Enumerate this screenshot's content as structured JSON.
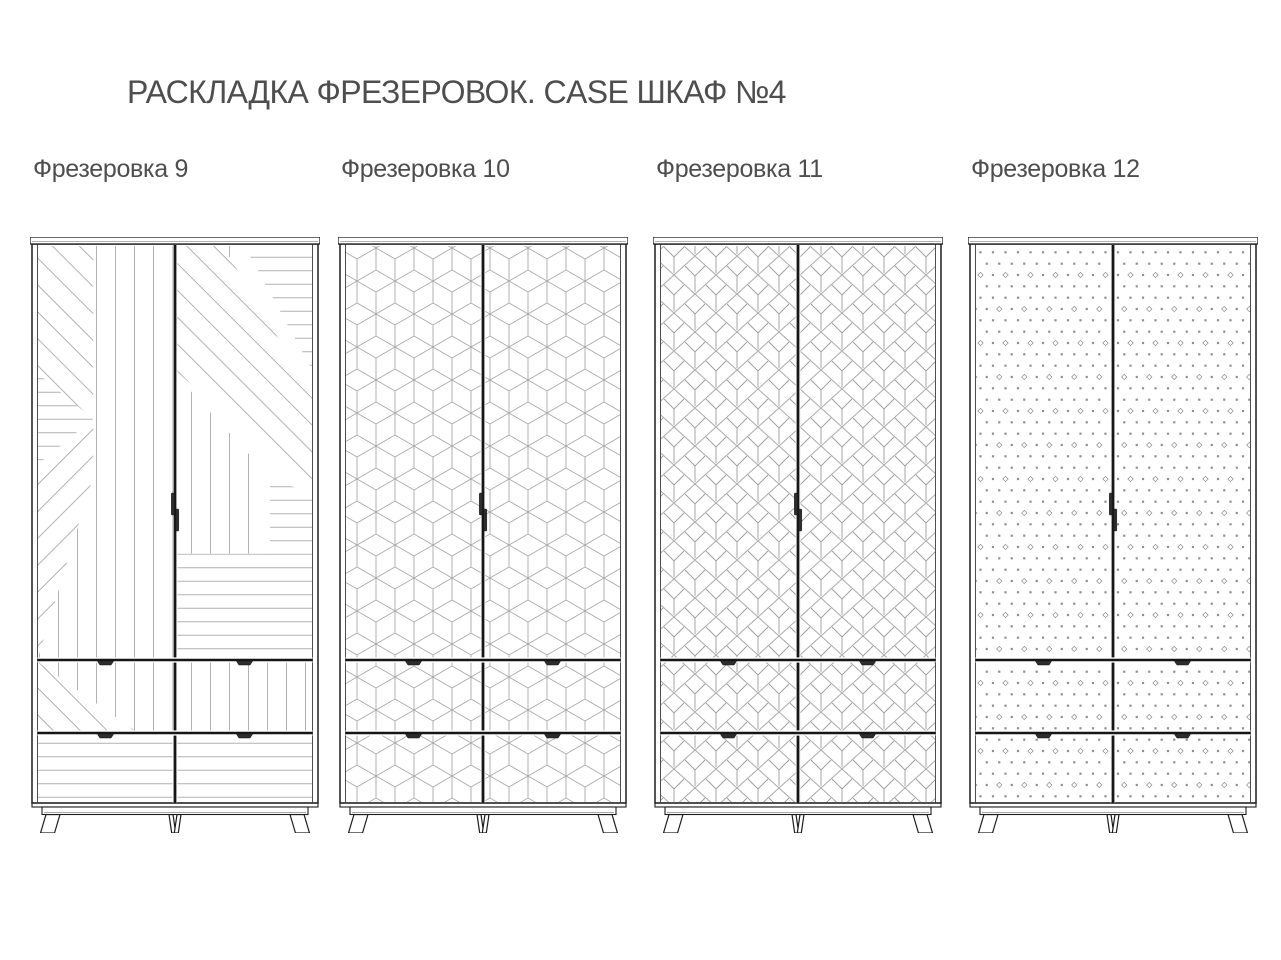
{
  "title": "РАСКЛАДКА ФРЕЗЕРОВОК. CASE ШКАФ №4",
  "colors": {
    "background": "#ffffff",
    "text": "#4e4e4e",
    "frame_line": "#1d1d1d",
    "pattern_line": "#b2b2b2",
    "handle": "#2d2d2d"
  },
  "cabinets": [
    {
      "label": "Фрезеровка 9",
      "pattern": "mixed-angle-stripes",
      "doors": 2,
      "drawer_rows": 2
    },
    {
      "label": "Фрезеровка 10",
      "pattern": "isometric-cubes",
      "doors": 2,
      "drawer_rows": 2
    },
    {
      "label": "Фрезеровка 11",
      "pattern": "art-deco-leaf-lattice",
      "doors": 2,
      "drawer_rows": 2
    },
    {
      "label": "Фрезеровка 12",
      "pattern": "dot-diamond-grid",
      "doors": 2,
      "drawer_rows": 2
    }
  ]
}
